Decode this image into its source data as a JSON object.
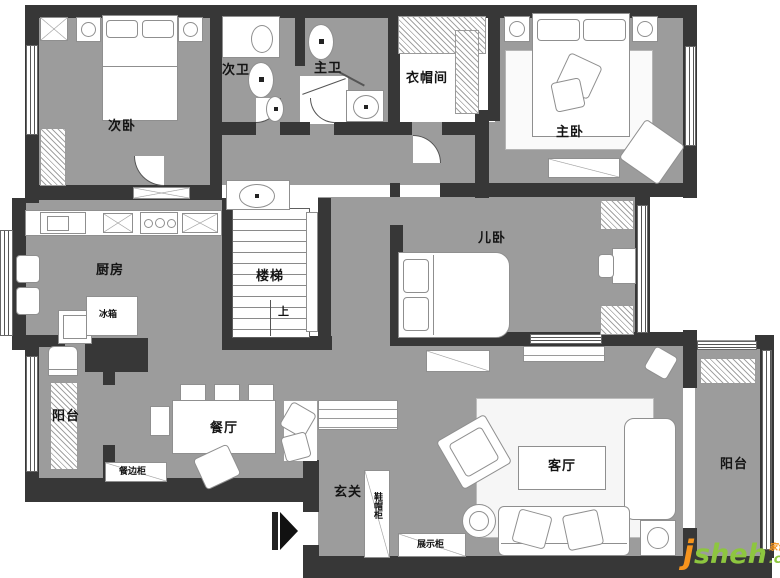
{
  "rooms": {
    "bedroom2": "次卧",
    "bath2": "次卫",
    "bath_master": "主卫",
    "cloakroom": "衣帽间",
    "bedroom_master": "主卧",
    "bedroom_kids": "儿卧",
    "stairs": "楼梯",
    "stairs_up": "上",
    "kitchen": "厨房",
    "balcony_left": "阳台",
    "dining": "餐厅",
    "foyer": "玄关",
    "living": "客厅",
    "balcony_right": "阳台"
  },
  "cabinets": {
    "fridge": "冰箱",
    "sideboard": "餐边柜",
    "shoe_hat": "鞋帽柜",
    "display": "展示柜"
  },
  "watermark": {
    "j": "j",
    "sheh": "sheh",
    "com": ".com",
    "cn": "家饰汇"
  },
  "colors": {
    "wall": "#373737",
    "floor": "#9c9c9c",
    "watermark_green": "#8dc63f",
    "watermark_orange": "#f7941d"
  }
}
